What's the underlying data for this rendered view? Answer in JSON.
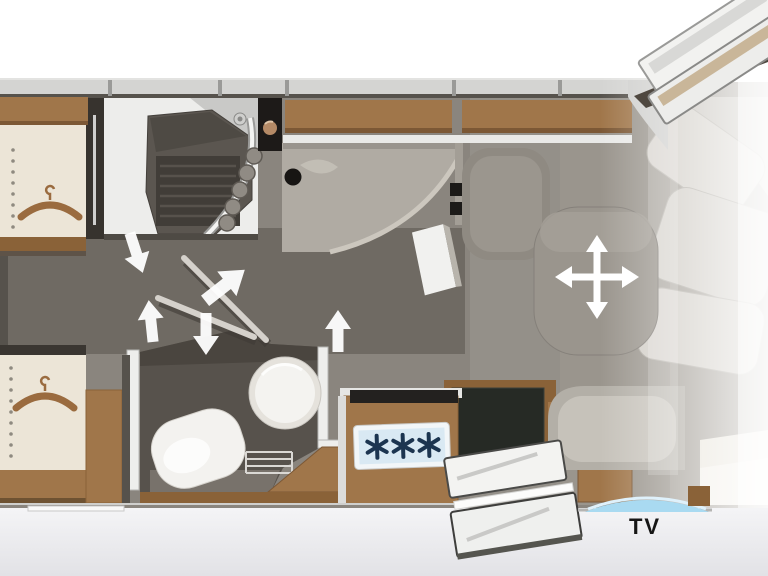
{
  "meta": {
    "description": "Motorhome floor plan, top view, rear section left and cab to the right"
  },
  "labels": {
    "tv": "TV"
  },
  "colors": {
    "outside": "#ffffff",
    "outside_lower": "#ececef",
    "floor": "#8a857e",
    "floor_rear": "#6f6a63",
    "floor_lounge": "#9a958d",
    "bath_wall": "#57524c",
    "shower_tray": "#5b5650",
    "shower_slats": "#413d38",
    "wood": "#a0764a",
    "wood_dark": "#8a6238",
    "cream": "#ece5d7",
    "white_fixture": "#f4f3f0",
    "seat_light": "#d2cec7",
    "seat_mid": "#b3afa7",
    "table": "#9a958d",
    "appliance_dark": "#262a25",
    "black_unit": "#1d1a18",
    "hob_panel": "#d9e9f3",
    "burner": "#1c3550",
    "tv_arc": "#a9daf1",
    "arrow": "#ffffff",
    "tv_text": "#161616",
    "wall_band": "#d4d4d2",
    "hanger": "#9a6b3f"
  },
  "icons": [
    {
      "name": "hanger-icon",
      "meaning": "wardrobe coat hanger",
      "count": 2
    },
    {
      "name": "burner-icon",
      "meaning": "gas hob burner (6-point star)",
      "count": 3
    },
    {
      "name": "move-table-icon",
      "meaning": "four-way movable table arrow cross",
      "count": 1
    },
    {
      "name": "swing-arrow-icon",
      "meaning": "swivelling bathroom wall direction arrow",
      "count": 5
    },
    {
      "name": "tv-arc",
      "meaning": "TV position arc on sideboard",
      "count": 1
    }
  ],
  "elements": [
    "rear-wardrobe-top",
    "shower-room",
    "swivel-bathroom-walls",
    "toilet-room",
    "rear-wardrobe-bottom",
    "kitchen-counter",
    "hob-unit",
    "dark-appliance-unit",
    "dinette-table",
    "lounge-seating",
    "entrance-door-open",
    "cab-door-open",
    "tv-sideboard"
  ]
}
